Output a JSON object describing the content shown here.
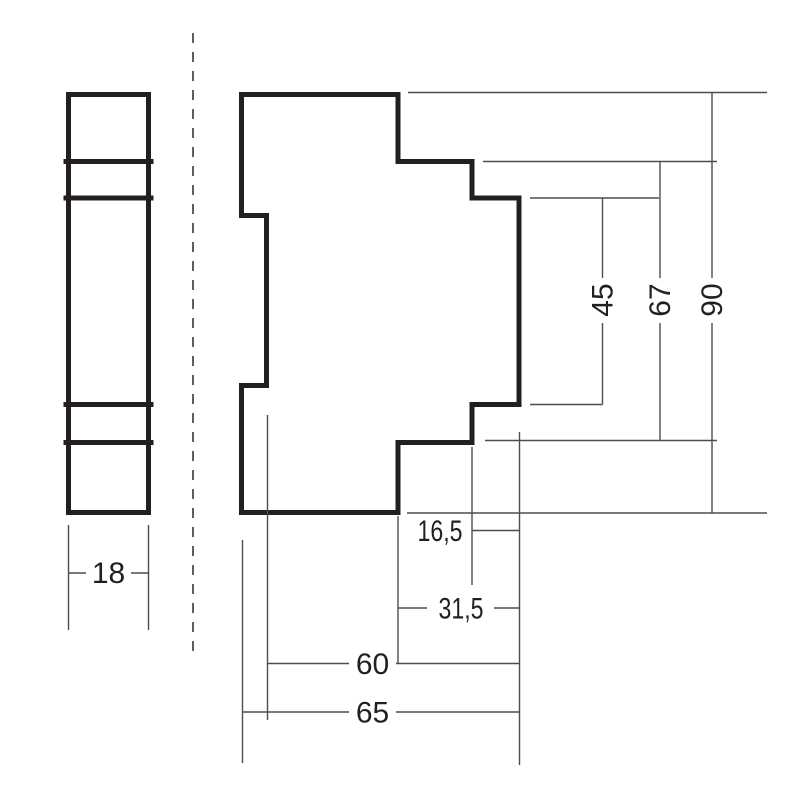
{
  "drawing": {
    "kind": "technical-dimension-drawing",
    "units": "mm",
    "colors": {
      "background": "#ffffff",
      "outline": "#231f20",
      "dimension_lines": "#4d4d4d",
      "text": "#231f20"
    },
    "front_view": {
      "width_dimension": {
        "label": "18"
      }
    },
    "side_view": {
      "vertical_dimensions": [
        {
          "name": "panel-height",
          "label": "45"
        },
        {
          "name": "mid-height",
          "label": "67"
        },
        {
          "name": "total-height",
          "label": "90"
        }
      ],
      "horizontal_dimensions": [
        {
          "name": "depth-16-5",
          "label": "16,5"
        },
        {
          "name": "depth-31-5",
          "label": "31,5"
        },
        {
          "name": "depth-60",
          "label": "60"
        },
        {
          "name": "depth-65",
          "label": "65"
        }
      ]
    }
  }
}
